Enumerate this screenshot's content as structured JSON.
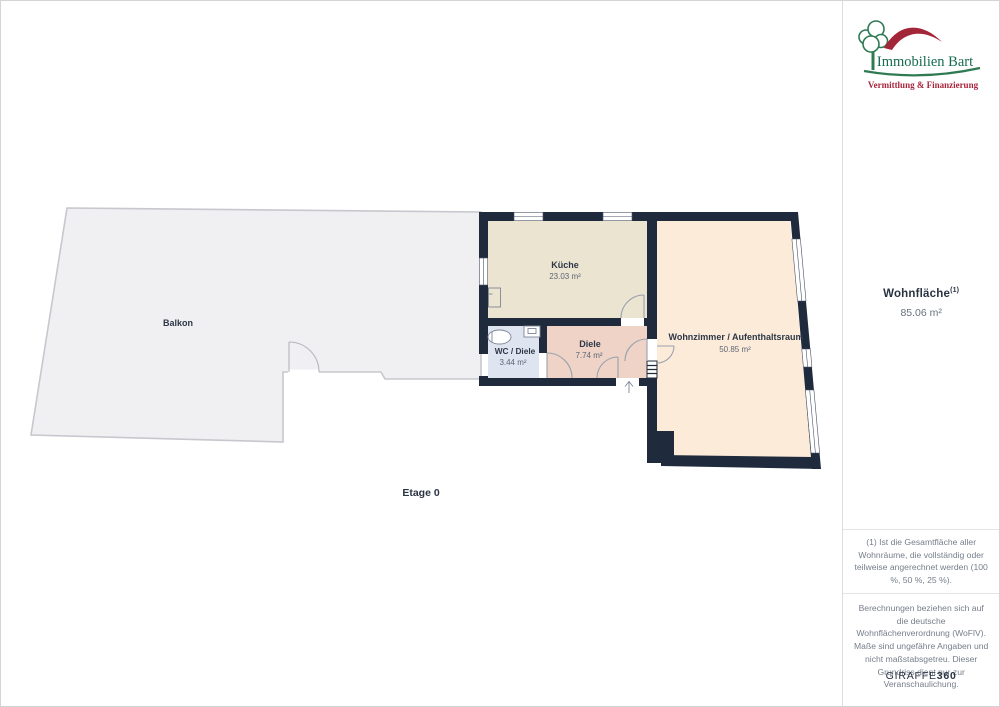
{
  "sidebar": {
    "logo": {
      "brand": "Immobilien Bart",
      "tagline": "Vermittlung & Finanzierung"
    },
    "area": {
      "label": "Wohnfläche",
      "sup": "(1)",
      "value": "85.06 m²"
    },
    "footnote": "(1) Ist die Gesamtfläche aller Wohnräume, die vollständig oder teilweise angerechnet werden (100 %, 50 %, 25 %).",
    "disclaimer": "Berechnungen beziehen sich auf die deutsche Wohnflächenverordnung (WoFlV). Maße sind ungefähre Angaben und nicht maßstabsgetreu. Dieser Grundriss dient nur zur Veranschaulichung.",
    "brand_footer": {
      "name": "GIRAFFE",
      "suffix": "360"
    }
  },
  "floorplan": {
    "floor_label": "Etage 0",
    "rooms": {
      "balkon": {
        "name": "Balkon"
      },
      "kueche": {
        "name": "Küche",
        "area": "23.03 m²"
      },
      "wc": {
        "name": "WC / Diele",
        "area": "3.44 m²"
      },
      "diele": {
        "name": "Diele",
        "area": "7.74 m²"
      },
      "wohnzimmer": {
        "name": "Wohnzimmer / Aufenthaltsraum",
        "area": "50.85 m²"
      }
    },
    "colors": {
      "wall": "#1f2b3d",
      "balkon": "#f0f0f2",
      "balkon_border": "#c6c8cd",
      "kueche": "#eae4d1",
      "wc": "#dfe5f0",
      "diele": "#eed3c6",
      "wohnzimmer": "#fcebd9",
      "brand_green": "#2f7a52",
      "brand_red": "#a32638"
    }
  }
}
